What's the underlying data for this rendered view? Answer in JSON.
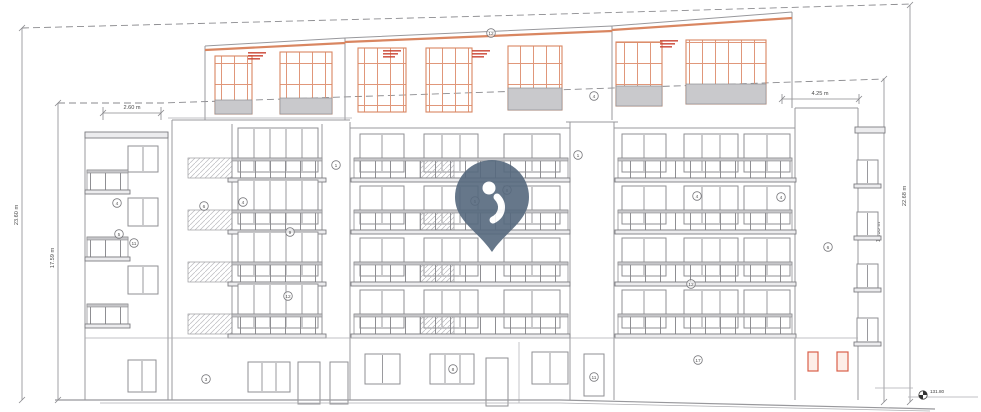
{
  "drawing": {
    "kind": "building-elevation",
    "dimensions": {
      "top_width": "2.60 m",
      "right_width": "4.25 m",
      "left_outer_height": "23.60 m",
      "left_inner_height": "17.59 m",
      "right_inner_height": "13.59 m",
      "right_outer_height": "22.68 m"
    },
    "level_marker": {
      "value": "131.80"
    },
    "keynotes": [
      {
        "n": "12",
        "x": 491,
        "y": 33
      },
      {
        "n": "4",
        "x": 594,
        "y": 96
      },
      {
        "n": "1",
        "x": 336,
        "y": 165
      },
      {
        "n": "1",
        "x": 578,
        "y": 155
      },
      {
        "n": "4",
        "x": 117,
        "y": 203
      },
      {
        "n": "4",
        "x": 243,
        "y": 202
      },
      {
        "n": "6",
        "x": 204,
        "y": 206
      },
      {
        "n": "8",
        "x": 507,
        "y": 190
      },
      {
        "n": "5",
        "x": 475,
        "y": 201
      },
      {
        "n": "5",
        "x": 119,
        "y": 234
      },
      {
        "n": "9",
        "x": 290,
        "y": 232
      },
      {
        "n": "11",
        "x": 134,
        "y": 243
      },
      {
        "n": "6",
        "x": 828,
        "y": 247
      },
      {
        "n": "12",
        "x": 288,
        "y": 296
      },
      {
        "n": "12",
        "x": 691,
        "y": 284
      },
      {
        "n": "4",
        "x": 697,
        "y": 196
      },
      {
        "n": "4",
        "x": 781,
        "y": 197
      },
      {
        "n": "3",
        "x": 206,
        "y": 379
      },
      {
        "n": "8",
        "x": 453,
        "y": 369
      },
      {
        "n": "11",
        "x": 594,
        "y": 377
      },
      {
        "n": "17",
        "x": 698,
        "y": 360
      }
    ],
    "colors": {
      "linework": "#98989c",
      "attic_accent": "#d98661",
      "annotation_red": "#c9402e",
      "pin": "#56697e"
    }
  }
}
